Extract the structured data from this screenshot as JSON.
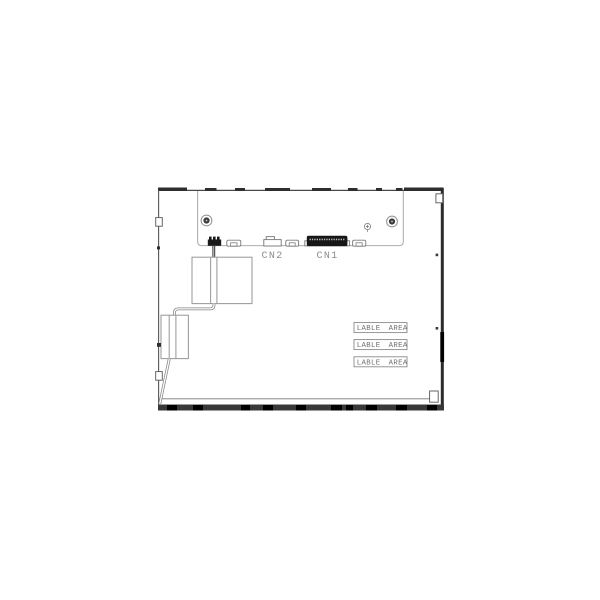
{
  "diagram": {
    "connectors": {
      "cn2_label": "CN2",
      "cn1_label": "CN1"
    },
    "label_areas": [
      "LABLE AREA",
      "LABLE AREA",
      "LABLE AREA"
    ],
    "colors": {
      "background": "#ffffff",
      "frame_dark": "#2e2e2e",
      "line_gray": "#9a9a9a",
      "text_gray": "#8c8c8c"
    }
  }
}
